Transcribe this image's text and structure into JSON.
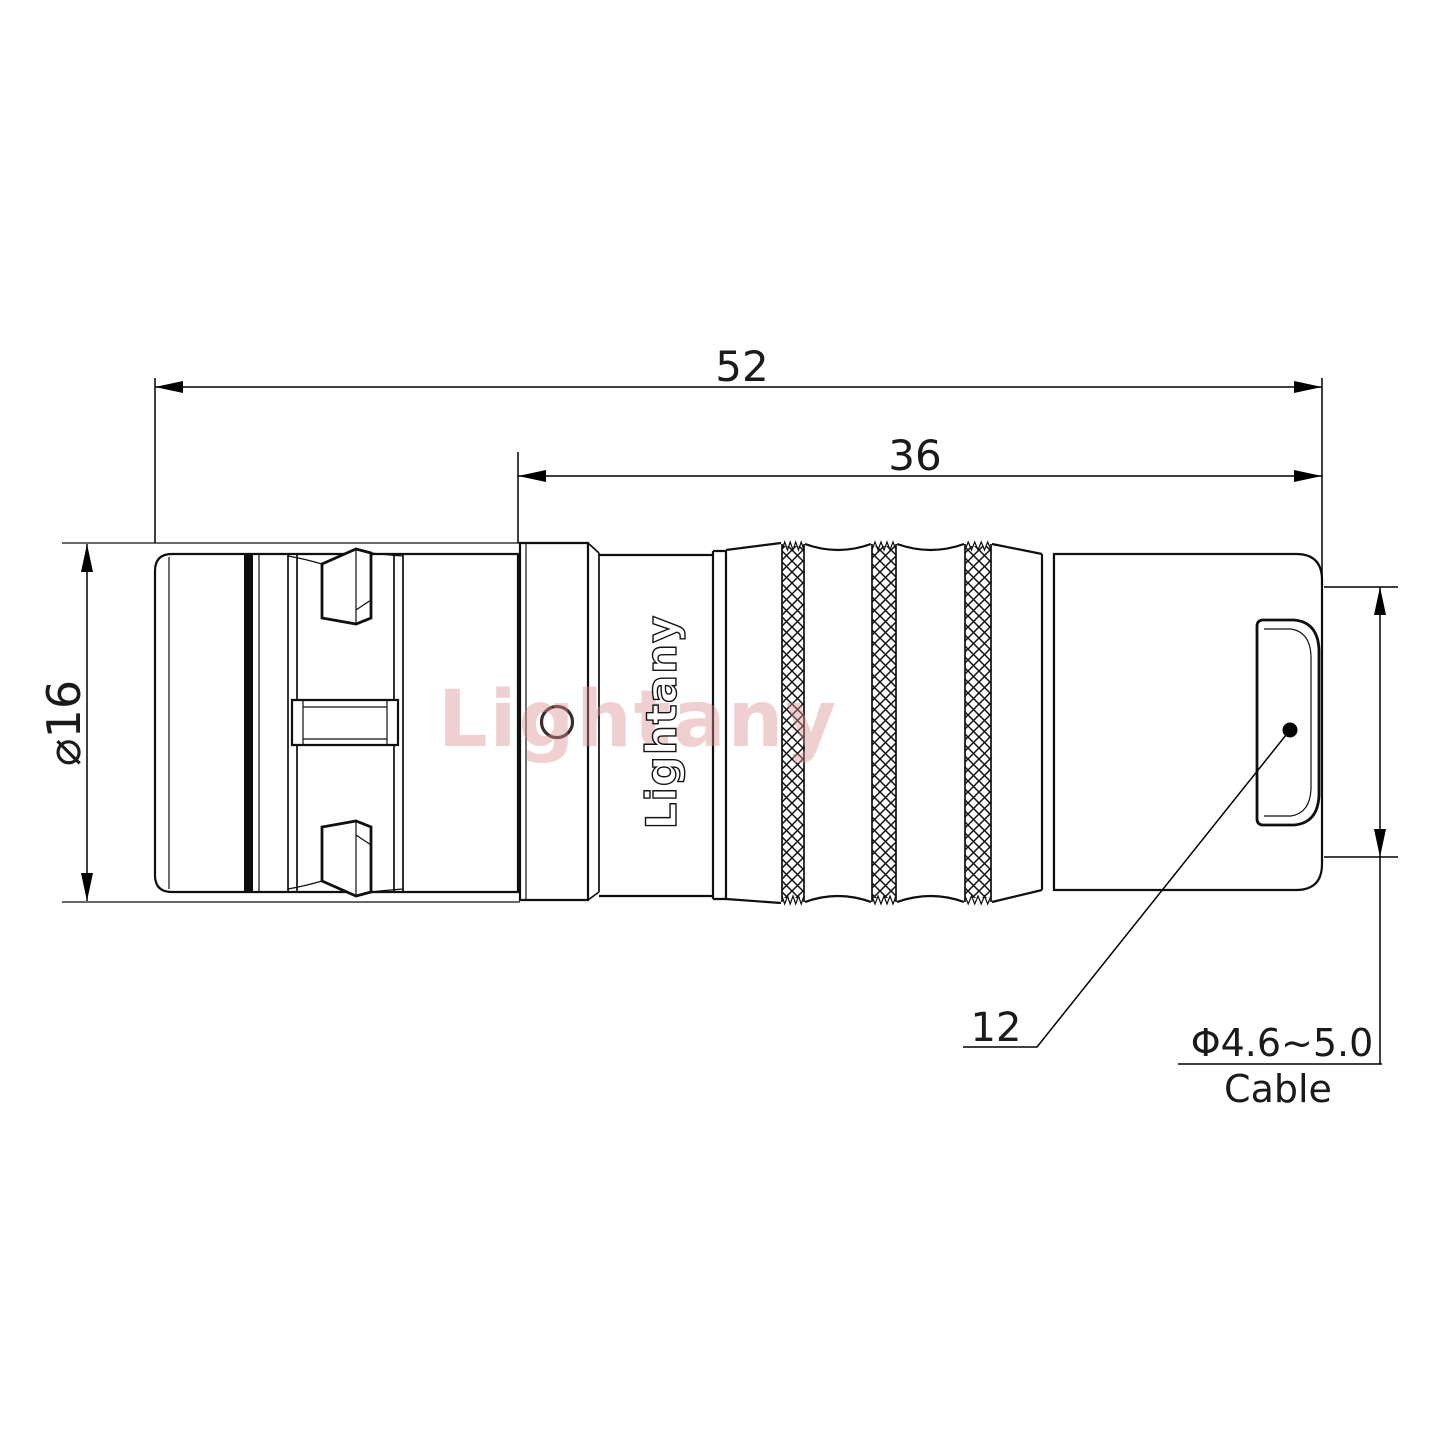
{
  "drawing": {
    "brand": "Lightany",
    "dims": {
      "overall_length": "52",
      "rear_length": "36",
      "front_diameter": "⌀16",
      "rear_diameter": "12"
    },
    "cable": {
      "size": "Φ4.6~5.0",
      "label": "Cable"
    },
    "colors": {
      "line": "#0f0f0f",
      "background": "#ffffff",
      "watermark_red": "#d98c8c",
      "hole_stroke": "#3d2b2b"
    }
  }
}
